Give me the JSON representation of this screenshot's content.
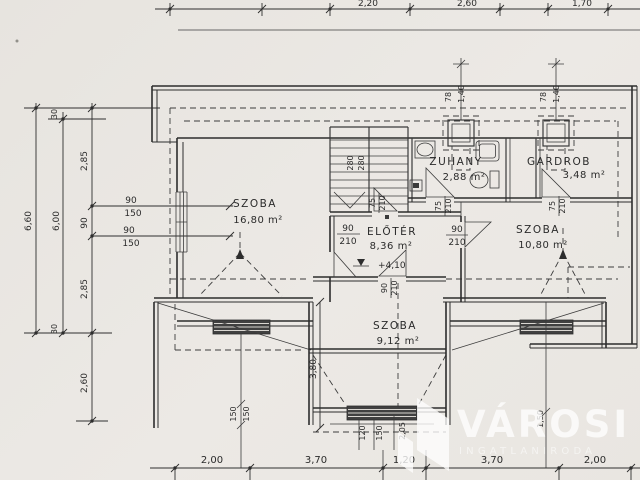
{
  "plan": {
    "rooms": {
      "szoba_nw": {
        "name": "SZOBA",
        "area": "16,80 m²"
      },
      "zuhany": {
        "name": "ZUHANY",
        "area": "2,88 m²"
      },
      "gardrob": {
        "name": "GARDROB",
        "area": "3,48 m²"
      },
      "eloter": {
        "name": "ELŐTÉR",
        "area": "8,36 m²"
      },
      "szoba_ne": {
        "name": "SZOBA",
        "area": "10,80 m²"
      },
      "szoba_s": {
        "name": "SZOBA",
        "area": "9,12 m²"
      }
    },
    "level_marker": "+4,10",
    "stair_dim": {
      "a": "280",
      "b": "280"
    }
  },
  "dims": {
    "top": {
      "f1": "2,20",
      "f2": "2,60",
      "f3": "1,70"
    },
    "bottom": {
      "d1": "2,00",
      "d2": "3,70",
      "d3": "1,20",
      "d4": "3,70",
      "d5": "2,00"
    },
    "left": {
      "total": "6,60",
      "inner": "6,00",
      "off_top": "30",
      "seg1": "2,85",
      "mid": "90",
      "seg2": "2,85",
      "off_bottom": "30",
      "below": "2,60"
    },
    "windows_w": {
      "w": "90",
      "h": "150"
    },
    "chimney": {
      "w": "78",
      "h": "1,40"
    },
    "doors": {
      "west": {
        "w": "90",
        "h": "210"
      },
      "east": {
        "w": "90",
        "h": "210"
      },
      "south": {
        "w": "90",
        "h": "210"
      },
      "zuhany_w": {
        "w": "75",
        "h": "210"
      },
      "zuhany_s": {
        "w": "75",
        "h": "210"
      },
      "gardrob": {
        "w": "75",
        "h": "210"
      }
    },
    "bay": {
      "depth": "3,80"
    },
    "windows_s": {
      "left1": "150",
      "left2": "150",
      "c1": "120",
      "c2": "150",
      "c3": "2,05",
      "right": "1,50"
    }
  },
  "watermark": {
    "title": "VÁROSI",
    "subtitle": "INGATLANIRODA"
  }
}
